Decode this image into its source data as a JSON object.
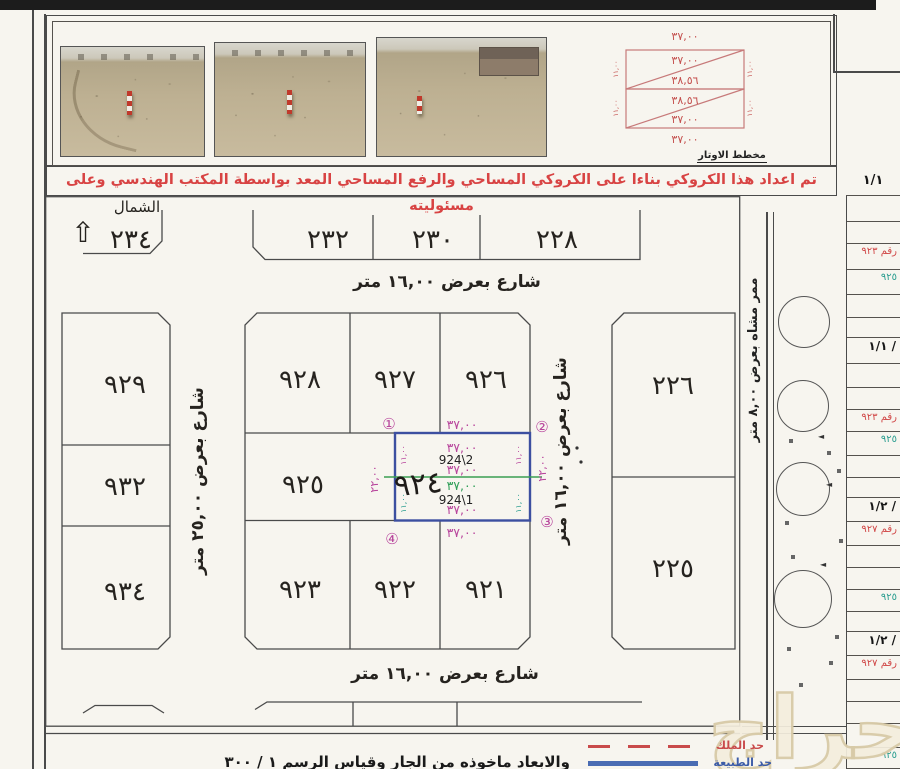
{
  "document": {
    "banner_text": "تم اعداد هذا الكروكي بناءا على الكروكي المساحي والرفع المساحي المعد بواسطة المكتب الهندسي وعلى مسئوليته",
    "page_ref": "١/١",
    "footer_note": "والابعاد ماخوذه من الجار وقياس الرسم ١ / ٣٠٠",
    "watermark": "حراج"
  },
  "photos": {
    "items": [
      {
        "desc": "desert site with red-white survey stake and tire tracks"
      },
      {
        "desc": "desert site with red-white survey stake"
      },
      {
        "desc": "desert site with building on horizon"
      }
    ]
  },
  "chord_diagram": {
    "title": "مخطط الاوتار",
    "width_above": "٣٧,٠٠",
    "rect1": {
      "width_top": "٣٧,٠٠",
      "diagonal": "٣٨,٥٦",
      "side": "١١,٠٠"
    },
    "rect2": {
      "diagonal": "٣٨,٥٦",
      "width_bottom": "٣٧,٠٠",
      "side": "١١,٠٠"
    },
    "width_below": "٣٧,٠٠"
  },
  "map": {
    "north_label": "الشمال",
    "north_arrow": "⇧",
    "plot_234": "٢٣٤",
    "top_plots": [
      "٢٣٢",
      "٢٣٠",
      "٢٢٨"
    ],
    "left_plots": [
      "٩٢٩",
      "٩٣٢",
      "٩٣٤"
    ],
    "center_top_plots": [
      "٩٢٨",
      "٩٢٧",
      "٩٢٦"
    ],
    "center_mid_plot": "٩٢٥",
    "center_bottom_plots": [
      "٩٢٣",
      "٩٢٢",
      "٩٢١"
    ],
    "right_plots": [
      "٢٢٦",
      "٢٢٥"
    ],
    "street_top": "شارع بعرض ١٦,٠٠ متر",
    "street_bottom": "شارع بعرض ١٦,٠٠ متر",
    "street_left": "شارع بعرض ٢٥,٠٠ متر",
    "street_right": "شارع بعرض ١٦,٠٠ متر",
    "walkway": "ممر مشاه بعرض ٨,٠٠ متر",
    "plot924": {
      "number": "٩٢٤",
      "sub_top": "924\\2",
      "sub_bottom": "924\\1",
      "width": "٣٧,٠٠",
      "depth_total": "٢٢,٠٠",
      "depth_half": "١١,٠٠",
      "corner_1": "①",
      "corner_2": "②",
      "corner_3": "③",
      "corner_4": "④"
    }
  },
  "side_table": {
    "rows": [
      {
        "h": 26,
        "text": "",
        "color": ""
      },
      {
        "h": 22,
        "text": "",
        "color": ""
      },
      {
        "h": 26,
        "text": "رقم ٩٢٣",
        "color": "red"
      },
      {
        "h": 25,
        "text": "٩٢٥",
        "color": "teal"
      },
      {
        "h": 23,
        "text": "",
        "color": ""
      },
      {
        "h": 20,
        "text": "",
        "color": ""
      },
      {
        "h": 26,
        "text": "١/١ /",
        "color": "black"
      },
      {
        "h": 24,
        "text": "",
        "color": ""
      },
      {
        "h": 22,
        "text": "",
        "color": ""
      },
      {
        "h": 22,
        "text": "رقم ٩٢٣",
        "color": "red"
      },
      {
        "h": 24,
        "text": "٩٢٥",
        "color": "teal"
      },
      {
        "h": 22,
        "text": "",
        "color": ""
      },
      {
        "h": 20,
        "text": "",
        "color": ""
      },
      {
        "h": 24,
        "text": "١/٢ /",
        "color": "black"
      },
      {
        "h": 24,
        "text": "رقم ٩٢٧",
        "color": "red"
      },
      {
        "h": 22,
        "text": "",
        "color": ""
      },
      {
        "h": 22,
        "text": "",
        "color": ""
      },
      {
        "h": 22,
        "text": "٩٢٥",
        "color": "teal"
      },
      {
        "h": 20,
        "text": "",
        "color": ""
      },
      {
        "h": 24,
        "text": "١/٢ /",
        "color": "black"
      },
      {
        "h": 24,
        "text": "رقم ٩٢٧",
        "color": "red"
      },
      {
        "h": 22,
        "text": "",
        "color": ""
      },
      {
        "h": 22,
        "text": "",
        "color": ""
      },
      {
        "h": 24,
        "text": "",
        "color": ""
      },
      {
        "h": 21,
        "text": "٩٢٥",
        "color": "teal"
      }
    ]
  },
  "legend": {
    "items": [
      {
        "label": "حد الملك",
        "style": "red-dashed",
        "color": "#c94b4b"
      },
      {
        "label": "حد الطبيعة",
        "style": "blue-solid",
        "color": "#3c5ca8"
      }
    ]
  },
  "colors": {
    "highlight_plot_border": "#3c4fa0",
    "annotation_magenta": "#b8459c",
    "annotation_green": "#2e9e57",
    "annotation_teal": "#2a9d8f",
    "banner_red": "#d84343",
    "chord_red": "#c4504e"
  }
}
